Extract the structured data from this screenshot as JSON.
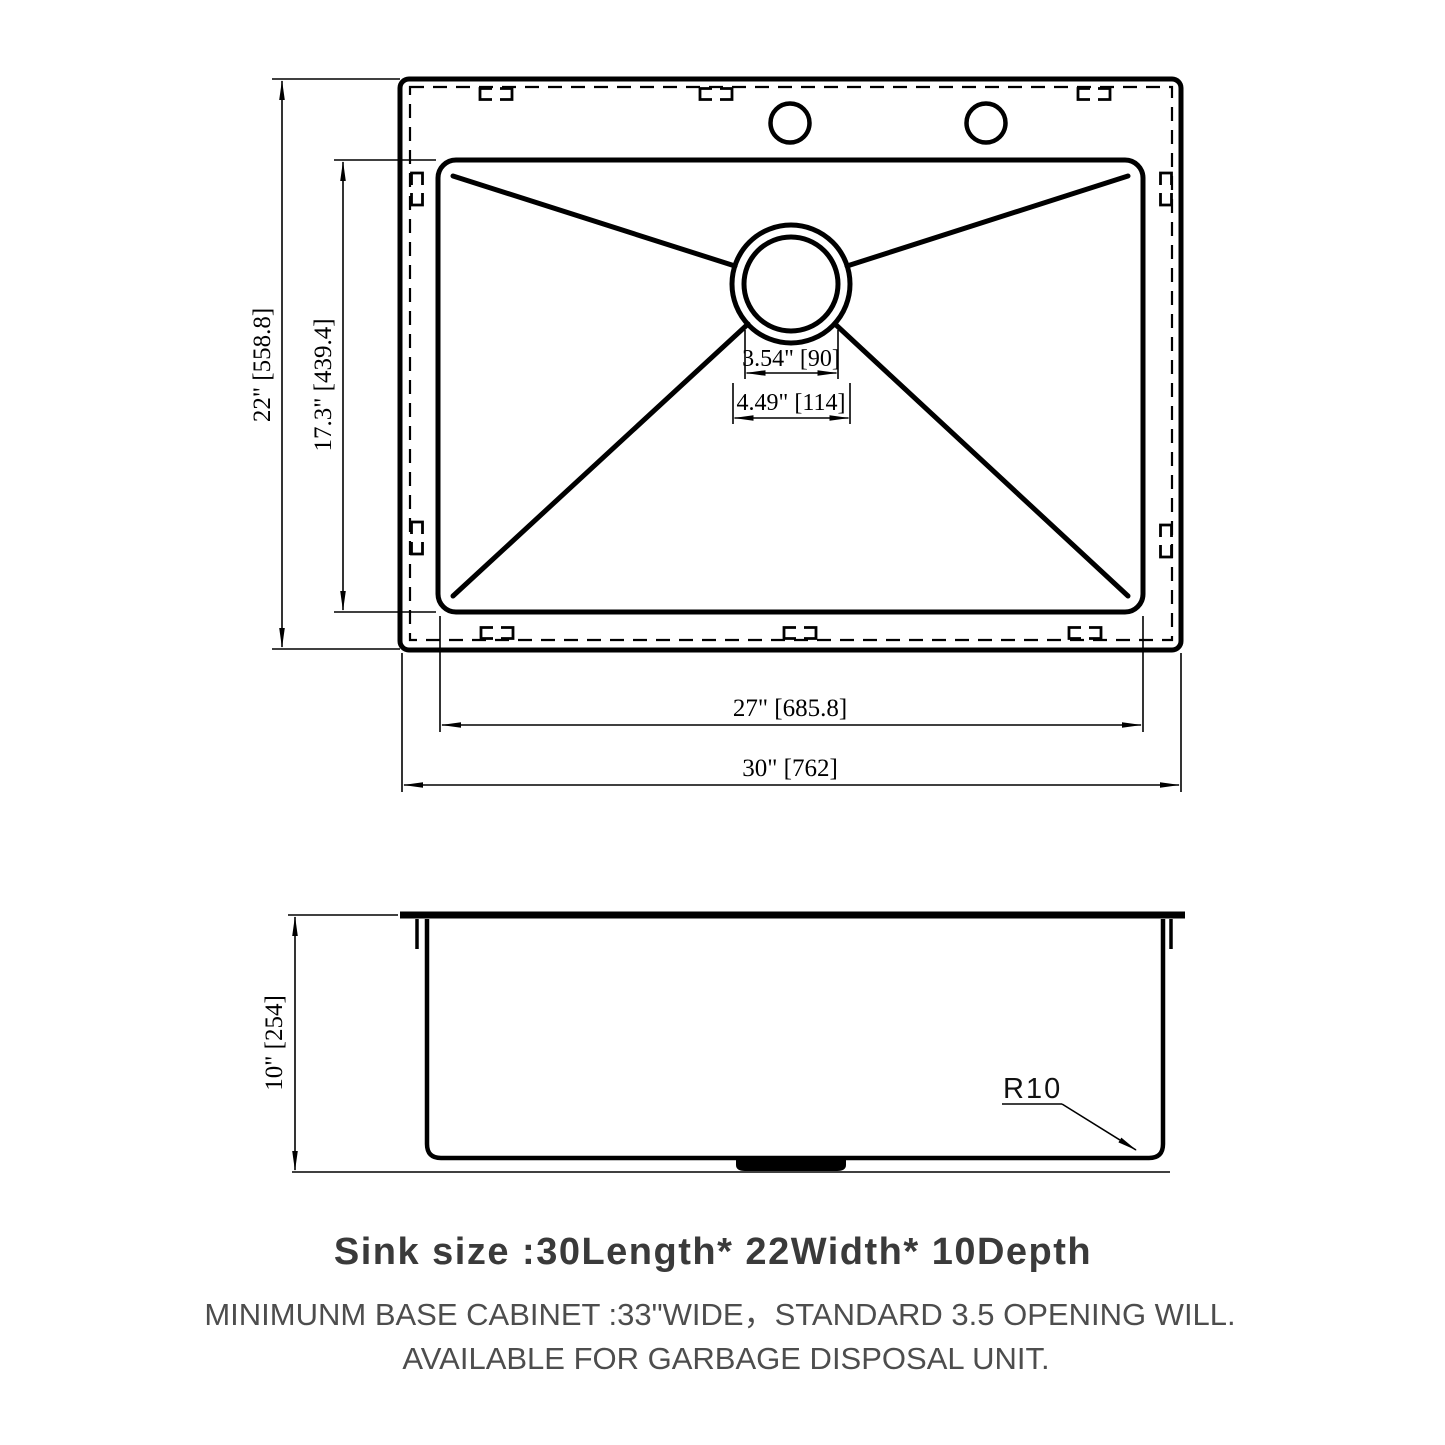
{
  "drawing_type": "sink technical drawing",
  "top_view": {
    "dims": {
      "overall_width": "22\" [558.8]",
      "bowl_width": "17.3\" [439.4]",
      "drain_inner": "3.54\" [90]",
      "drain_outer": "4.49\" [114]",
      "bowl_length": "27\" [685.8]",
      "overall_length": "30\" [762]"
    }
  },
  "side_view": {
    "dims": {
      "depth": "10\" [254]",
      "corner_radius": "R10"
    }
  },
  "notes": {
    "title": "Sink size :30Length* 22Width* 10Depth",
    "line1": "MINIMUNM BASE CABINET :33\"WIDE，STANDARD 3.5 OPENING WILL.",
    "line2": "AVAILABLE FOR GARBAGE DISPOSAL UNIT."
  },
  "colors": {
    "line": "#000000",
    "title_text": "#3a3a3a",
    "note_text": "#4d4d4d",
    "background": "#ffffff"
  }
}
